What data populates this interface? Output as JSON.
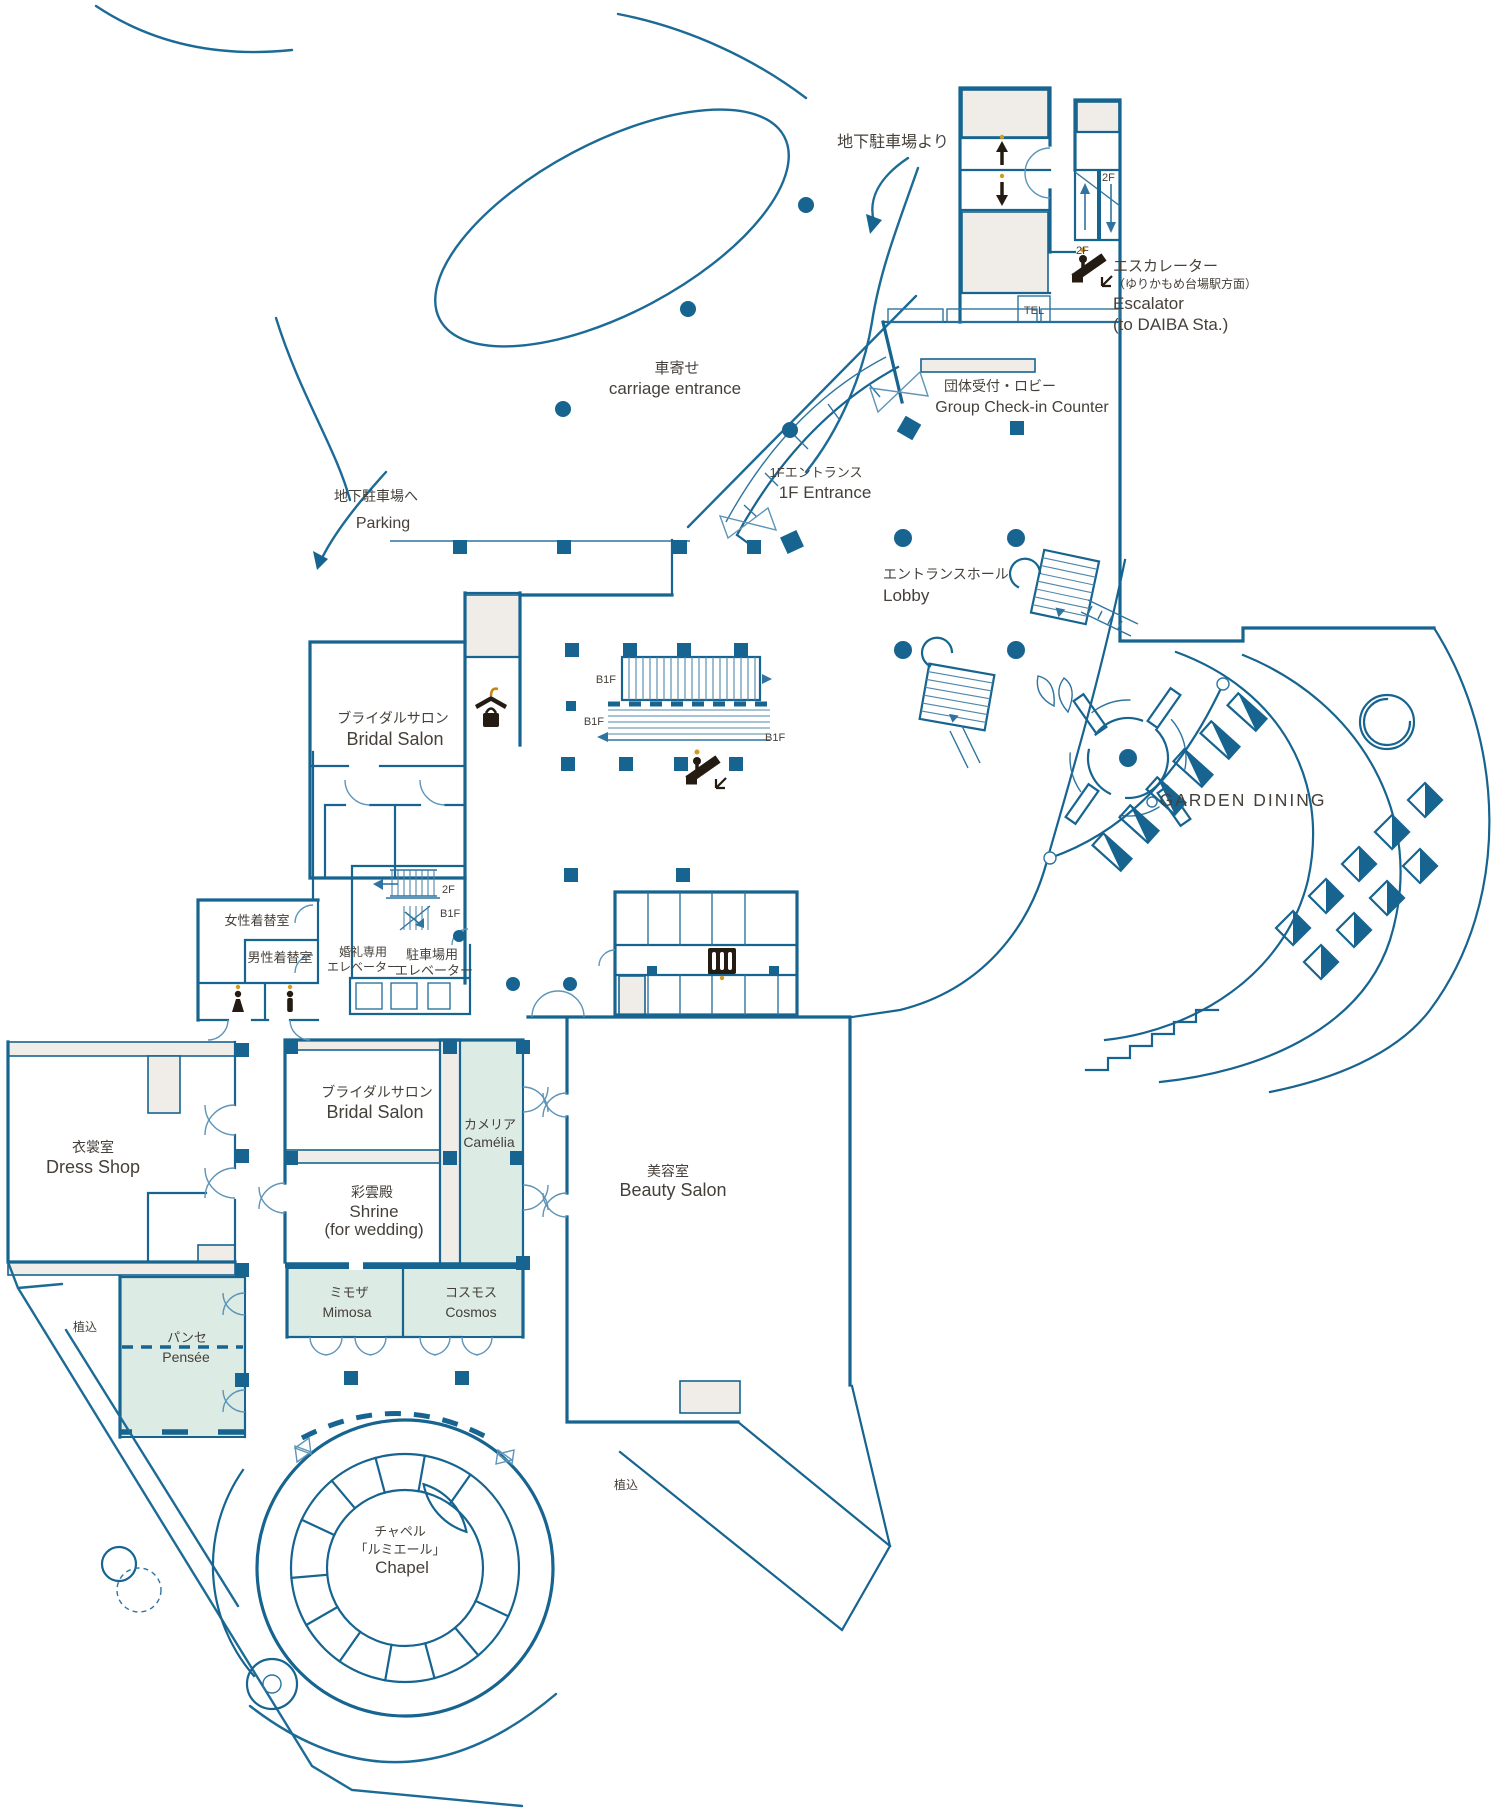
{
  "colors": {
    "wall_blue": "#16648f",
    "room_gray": "#f0ece7",
    "room_green": "#dcebe3",
    "icon_black": "#241c12",
    "icon_orange": "#d29a1e",
    "text": "#46403a"
  },
  "markers": {
    "f2": "2F",
    "b1f": "B1F",
    "tel": "TEL"
  },
  "notes": {
    "from_parking": "地下駐車場より",
    "to_parking_jp": "地下駐車場へ",
    "to_parking_en": "Parking",
    "escalator_jp": "エスカレーター",
    "escalator_dir": "（ゆりかもめ台場駅方面）",
    "escalator_en": "Escalator",
    "escalator_dest": "(to DAIBA Sta.)",
    "planting": "植込"
  },
  "areas": {
    "carriage": {
      "jp": "車寄せ",
      "en": "carriage entrance"
    },
    "group_checkin": {
      "jp": "団体受付・ロビー",
      "en": "Group Check-in Counter"
    },
    "entrance": {
      "jp": "1Fエントランス",
      "en": "1F Entrance"
    },
    "lobby": {
      "jp": "エントランスホール",
      "en": "Lobby"
    },
    "garden_dining": {
      "en": "GARDEN DINING"
    },
    "bridal_salon": {
      "jp": "ブライダルサロン",
      "en": "Bridal Salon"
    },
    "womens_changing": {
      "jp": "女性着替室"
    },
    "mens_changing": {
      "jp": "男性着替室"
    },
    "wedding_elevator": {
      "jp1": "婚礼専用",
      "jp2": "エレベーター"
    },
    "parking_elevator": {
      "jp1": "駐車場用",
      "jp2": "エレベーター"
    },
    "dress_shop": {
      "jp": "衣裳室",
      "en": "Dress Shop"
    },
    "camelia": {
      "jp": "カメリア",
      "en": "Camélia"
    },
    "shrine": {
      "jp": "彩雲殿",
      "en1": "Shrine",
      "en2": "(for wedding)"
    },
    "beauty_salon": {
      "jp": "美容室",
      "en": "Beauty Salon"
    },
    "mimosa": {
      "jp": "ミモザ",
      "en": "Mimosa"
    },
    "cosmos": {
      "jp": "コスモス",
      "en": "Cosmos"
    },
    "pensee": {
      "jp": "パンセ",
      "en": "Pensée"
    },
    "chapel": {
      "jp1": "チャペル",
      "jp2": "「ルミエール」",
      "en": "Chapel"
    }
  }
}
